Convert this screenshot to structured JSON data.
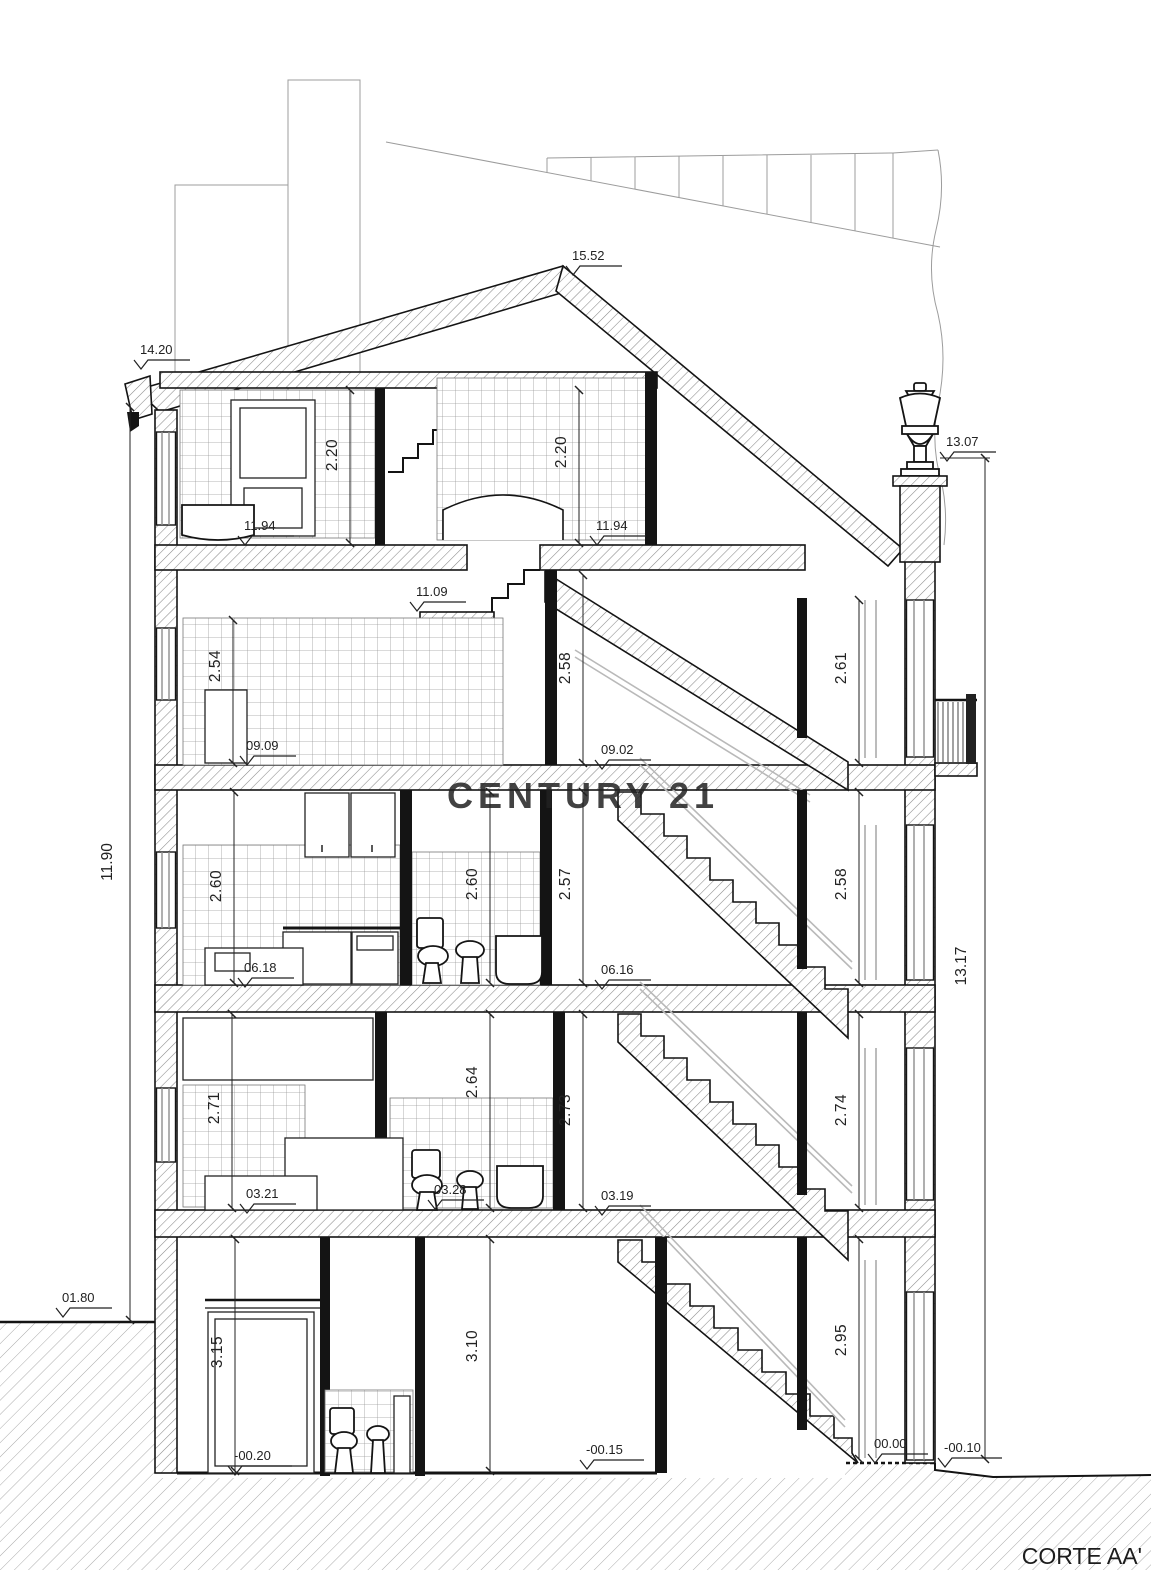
{
  "title": "CORTE AA'",
  "watermark": "CENTURY 21",
  "colors": {
    "drawing_line": "#1a1a1a",
    "background_line": "#9c9c9c",
    "watermark": "#cdc5a6",
    "paper": "#ffffff"
  },
  "levels": [
    {
      "label": "15.52"
    },
    {
      "label": "14.20"
    },
    {
      "label": "13.07"
    },
    {
      "label": "11.94"
    },
    {
      "label": "11.94"
    },
    {
      "label": "11.09"
    },
    {
      "label": "09.09"
    },
    {
      "label": "09.02"
    },
    {
      "label": "06.18"
    },
    {
      "label": "06.16"
    },
    {
      "label": "03.21"
    },
    {
      "label": "03.28"
    },
    {
      "label": "03.19"
    },
    {
      "label": "01.80"
    },
    {
      "label": "-00.20"
    },
    {
      "label": "-00.15"
    },
    {
      "label": "00.00"
    },
    {
      "label": "-00.10"
    }
  ],
  "room_heights": [
    {
      "label": "2.20"
    },
    {
      "label": "2.20"
    },
    {
      "label": "2.54"
    },
    {
      "label": "2.58"
    },
    {
      "label": "2.61"
    },
    {
      "label": "2.60"
    },
    {
      "label": "2.60"
    },
    {
      "label": "2.57"
    },
    {
      "label": "2.58"
    },
    {
      "label": "2.71"
    },
    {
      "label": "2.64"
    },
    {
      "label": "2.73"
    },
    {
      "label": "2.74"
    },
    {
      "label": "3.15"
    },
    {
      "label": "3.10"
    },
    {
      "label": "2.95"
    }
  ],
  "overall_dims": [
    {
      "label": "11.90"
    },
    {
      "label": "13.17"
    }
  ]
}
